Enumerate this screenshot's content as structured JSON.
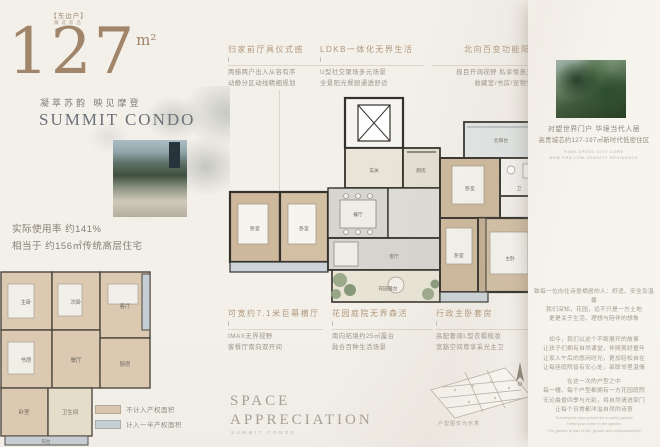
{
  "page": {
    "background": "#f3f0ea",
    "accent_bronze": "#a1856a",
    "title_gray": "#6b7178"
  },
  "hero": {
    "tag": "【东边户】",
    "subtag": "臻选新品",
    "area_number": "127",
    "area_unit": "m²",
    "slogan": "凝萃苏韵 映见摩登",
    "title": "SUMMIT CONDO"
  },
  "usage": {
    "line1": "实际使用率 约141%",
    "line2": "相当于 约156㎡传统高层住宅"
  },
  "annotations_top": [
    {
      "title": "归家前厅具仪式感",
      "lines": [
        "两梯两户出入从容有序",
        "动静分区动线精细规划"
      ]
    },
    {
      "title": "LDKB一体化无界生活",
      "lines": [
        "U型社交聚场多元场景",
        "全景阳光餐厨通透舒适"
      ]
    },
    {
      "title": "北向百变功能阳台",
      "lines": [
        "极目开阔视野 私享惬意天地",
        "收藏室/书房/宠物空间"
      ]
    }
  ],
  "annotations_bottom": [
    {
      "title": "可宽约7.1米巨幕横厅",
      "lines": [
        "IMAX无界视野",
        "客餐厅南向双开间"
      ]
    },
    {
      "title": "花园庭院无界森活",
      "lines": [
        "南向拓境约25㎡露台",
        "融合百种生活场景"
      ]
    },
    {
      "title": "行政主卧套房",
      "lines": [
        "高配奢阔L型衣帽梳妆",
        "宽豁空间尊享采光主卫"
      ]
    }
  ],
  "legend": {
    "items": [
      {
        "label": "不计入产权面积",
        "color": "#d9c7b0"
      },
      {
        "label": "计入一半产权面积",
        "color": "#c4ced5"
      }
    ]
  },
  "floorplan": {
    "main_rooms": [
      "玄关",
      "厨房",
      "餐厅",
      "客厅",
      "花园露台",
      "北阳台",
      "卧室",
      "卫",
      "卧室",
      "主卧",
      "卧室",
      "卧室"
    ],
    "compare_rooms": [
      "主卧",
      "次卧",
      "客厅",
      "书房",
      "餐厅",
      "厨房",
      "卧室",
      "卫生间",
      "阳台"
    ]
  },
  "footer": {
    "space_line1": "SPACE",
    "space_line2": "APPRECIATION",
    "space_sub": "SUMMIT CONDO",
    "plan_caption": "户型图仅为示意"
  },
  "sidebar": {
    "headline1": "对望世界门户 华境当代人居",
    "headline2": "高贵城芯约127-197㎡新时代低密住区",
    "sub_en1": "HIGH-SPEED CITY CORE",
    "sub_en2": "NEW ERA LOW-DENSITY RESIDENCE",
    "paragraphs": [
      {
        "lines": [
          "致每一位向往诗意栖居的人：舒适、安全及温馨"
        ]
      },
      {
        "lines": [
          "我们深知，花园，远不只是一方土地",
          "更是关于生活、理想与陪伴的想象"
        ]
      },
      {
        "lines": [
          "如今，我们以这个不断展开的故事",
          "让孩子们拥有自然课堂，伴随美好童年",
          "让家人午后的悠闲时光，更加轻松自在",
          "让每座庭院皆有安心处，串联邻里温情"
        ]
      },
      {
        "lines": [
          "在这一次的户型之中",
          "每一幢、每个户型都拥有一方花园庭院",
          "无论晨昏四季与光影，将自然请进家门",
          "让每个日常都洋溢自然的诗意"
        ]
      }
    ],
    "footer_en": [
      "To everyone who yearns for a poetic garden",
      "Keep your home in the garden",
      "The garden is part of life, growth and companionship"
    ]
  }
}
